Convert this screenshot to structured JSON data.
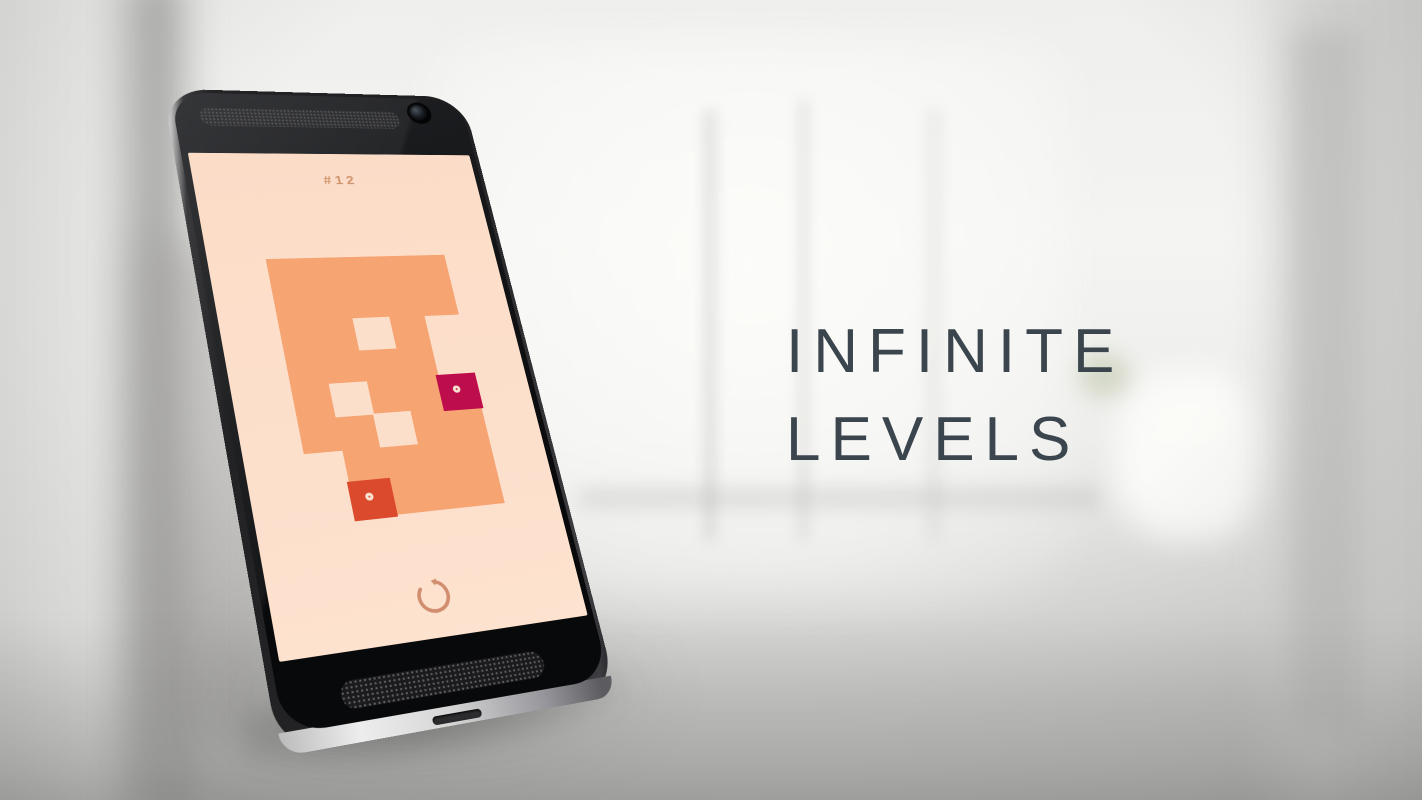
{
  "hero": {
    "title_line1": "INFINITE",
    "title_line2": "LEVELS"
  },
  "phone": {
    "screen": {
      "level_label": "#12",
      "board": {
        "cols": 5,
        "rows": 8,
        "grid": [
          "OOOOO",
          "OOOOO",
          "OOLO.",
          "OOOO.",
          "OLOOC",
          "OOLOO",
          ".OOOO",
          ".ROOO"
        ],
        "legend": {
          "O": "orange-tile",
          "L": "light-tile",
          "C": "crimson-piece-with-ring",
          "R": "red-piece-with-ring",
          ".": "empty"
        }
      },
      "restart_icon": "counterclockwise-circular-arrow"
    }
  },
  "colors": {
    "screen_bg": "#fbdcc7",
    "screen_bg_bottom": "#fde2cf",
    "board_orange": "#f6a472",
    "board_light": "#fcdfcb",
    "piece_crimson": "#be0d4d",
    "piece_red": "#dc4a2e",
    "piece_ring": "#f8e3d1",
    "hud_text": "#d0936c",
    "restart_icon": "#d18d6e",
    "title_text": "#3b454d"
  }
}
